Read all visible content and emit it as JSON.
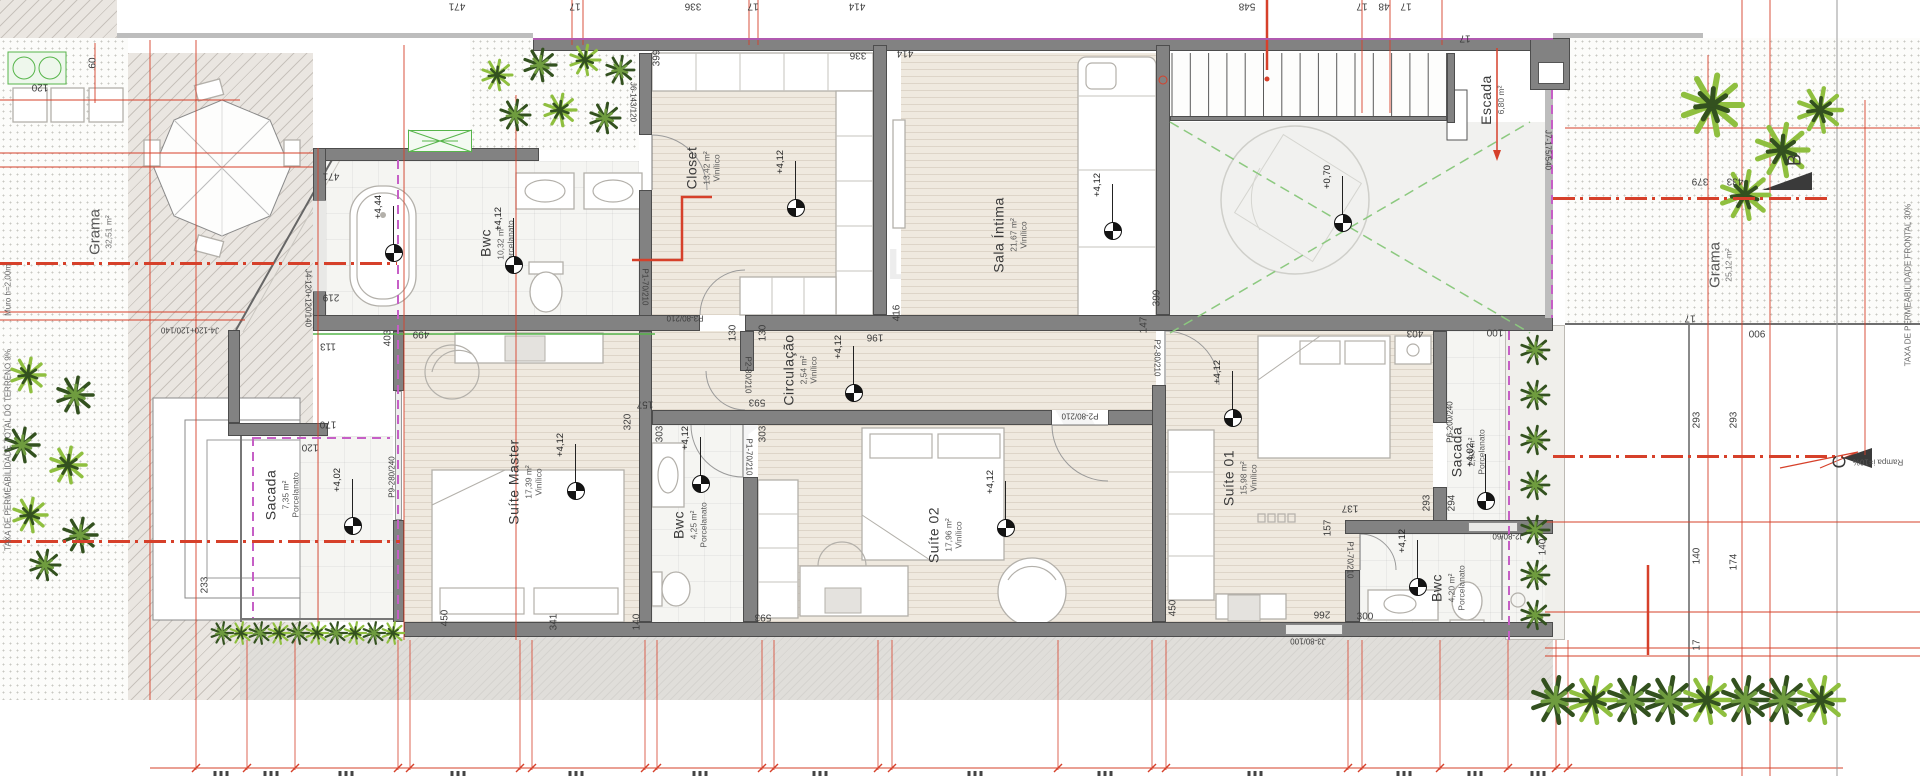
{
  "plan": {
    "colors": {
      "accent_red": "#d6402a",
      "wall_gray": "#828282",
      "magenta": "#c65fc6",
      "green_window": "#57b54b",
      "green_dash": "#8cc97f",
      "palm_dark": "#33511f",
      "palm_light": "#8fbf3f"
    },
    "watermark": {
      "brand": "IMOBILIÁRIA",
      "monogram": "KIN"
    },
    "yard_left": {
      "name": "Grama",
      "area": "32,51 m²",
      "x": 100,
      "y": 232
    },
    "yard_right": {
      "name": "Grama",
      "area": "25,12 m²",
      "x": 1720,
      "y": 265
    },
    "notes": {
      "left_wall": {
        "text": "Muro h=2,00m",
        "x": 8,
        "y": 290,
        "r": -90
      },
      "left_taxa": {
        "text": "TAXA DE PERMEABILIDADE TOTAL DO TERRENO 9%",
        "x": 8,
        "y": 450,
        "r": -90
      },
      "right_taxa": {
        "text": "TAXA DE PERMEABILIDADE FRONTAL 30%",
        "x": 1908,
        "y": 285,
        "r": -90
      },
      "ramp": {
        "text": "Rampa i=10%",
        "x": 1878,
        "y": 462,
        "r": 180
      }
    },
    "section_markers": [
      {
        "label": "B",
        "x": 1795,
        "y": 160
      },
      {
        "label": "C",
        "x": 1840,
        "y": 462
      }
    ],
    "rooms": [
      {
        "id": "bwc-master",
        "name": "Bwc",
        "area": "10,32 m²",
        "material": "Porcelanato",
        "floor": "porc",
        "x": 326,
        "y": 161,
        "w": 313,
        "h": 154,
        "lx": 497,
        "ly": 243
      },
      {
        "id": "closet",
        "name": "Closet",
        "area": "13,42 m²",
        "material": "Vinílico",
        "floor": "wood",
        "x": 652,
        "y": 53,
        "w": 221,
        "h": 262,
        "lx": 703,
        "ly": 168
      },
      {
        "id": "sala-intima",
        "name": "Sala Íntima",
        "area": "21,67 m²",
        "material": "Vinílico",
        "floor": "wood",
        "x": 901,
        "y": 53,
        "w": 255,
        "h": 262,
        "lx": 1010,
        "ly": 235
      },
      {
        "id": "escada",
        "name": "Escada",
        "area": "6,80 m²",
        "material": "",
        "floor": "none",
        "x": 1170,
        "y": 53,
        "w": 277,
        "h": 63,
        "lx": 1492,
        "ly": 100
      },
      {
        "id": "circulacao",
        "name": "Circulação",
        "area": "2,54 m²",
        "material": "Vinílico",
        "floor": "wood",
        "x": 652,
        "y": 331,
        "w": 504,
        "h": 79,
        "lx": 800,
        "ly": 370
      },
      {
        "id": "suite-master",
        "name": "Suíte Master",
        "area": "17,39 m²",
        "material": "Vinílico",
        "floor": "wood",
        "x": 404,
        "y": 331,
        "w": 235,
        "h": 291,
        "lx": 525,
        "ly": 482
      },
      {
        "id": "sacada-esq",
        "name": "Sacada",
        "area": "7,35 m²",
        "material": "Porcelanato",
        "floor": "porc",
        "x": 240,
        "y": 436,
        "w": 153,
        "h": 186,
        "lx": 282,
        "ly": 495
      },
      {
        "id": "bwc-meio",
        "name": "Bwc",
        "area": "4,25 m²",
        "material": "Porcelanato",
        "floor": "porc",
        "x": 652,
        "y": 425,
        "w": 91,
        "h": 197,
        "lx": 690,
        "ly": 525
      },
      {
        "id": "suite-02",
        "name": "Suíte 02",
        "area": "17,96 m²",
        "material": "Vinílico",
        "floor": "wood",
        "x": 758,
        "y": 425,
        "w": 394,
        "h": 197,
        "lx": 945,
        "ly": 535
      },
      {
        "id": "suite-01",
        "name": "Suíte 01",
        "area": "15,98 m²",
        "material": "Vinílico",
        "floor": "wood",
        "x": 1166,
        "y": 331,
        "w": 267,
        "h": 291,
        "lx": 1240,
        "ly": 478
      },
      {
        "id": "sacada-dir",
        "name": "Sacada",
        "area": "2,93 m²",
        "material": "Porcelanato",
        "floor": "porc",
        "x": 1447,
        "y": 331,
        "w": 58,
        "h": 291,
        "lx": 1468,
        "ly": 452
      },
      {
        "id": "bwc-suite01",
        "name": "Bwc",
        "area": "4,20 m²",
        "material": "Porcelanato",
        "floor": "porc",
        "x": 1360,
        "y": 534,
        "w": 185,
        "h": 88,
        "lx": 1448,
        "ly": 588
      }
    ],
    "levels": [
      {
        "v": "+4,44",
        "x": 393,
        "y": 252
      },
      {
        "v": "+4,12",
        "x": 513,
        "y": 264
      },
      {
        "v": "+4,12",
        "x": 795,
        "y": 207
      },
      {
        "v": "+4,12",
        "x": 1112,
        "y": 230
      },
      {
        "v": "+0,70",
        "x": 1342,
        "y": 222
      },
      {
        "v": "+4,12",
        "x": 853,
        "y": 392
      },
      {
        "v": "+4,12",
        "x": 575,
        "y": 490
      },
      {
        "v": "+4,02",
        "x": 352,
        "y": 525
      },
      {
        "v": "+4,12",
        "x": 700,
        "y": 483
      },
      {
        "v": "+4,12",
        "x": 1005,
        "y": 527
      },
      {
        "v": "+4,12",
        "x": 1232,
        "y": 417
      },
      {
        "v": "+4,02",
        "x": 1485,
        "y": 500
      },
      {
        "v": "+4,12",
        "x": 1417,
        "y": 586
      }
    ],
    "dims": [
      {
        "t": "471",
        "x": 457,
        "y": 6,
        "r": 180
      },
      {
        "t": "17",
        "x": 575,
        "y": 6,
        "r": 180
      },
      {
        "t": "336",
        "x": 693,
        "y": 6,
        "r": 180
      },
      {
        "t": "17",
        "x": 753,
        "y": 6,
        "r": 180
      },
      {
        "t": "414",
        "x": 857,
        "y": 6,
        "r": 180
      },
      {
        "t": "548",
        "x": 1247,
        "y": 6,
        "r": 180
      },
      {
        "t": "17",
        "x": 1362,
        "y": 6,
        "r": 180
      },
      {
        "t": "48",
        "x": 1384,
        "y": 6,
        "r": 180
      },
      {
        "t": "17",
        "x": 1406,
        "y": 6,
        "r": 180
      },
      {
        "t": "17",
        "x": 1465,
        "y": 38,
        "r": 180
      },
      {
        "t": "60",
        "x": 93,
        "y": 63,
        "r": -90
      },
      {
        "t": "120",
        "x": 40,
        "y": 87,
        "r": 180
      },
      {
        "t": "471",
        "x": 331,
        "y": 176,
        "r": 180
      },
      {
        "t": "219",
        "x": 331,
        "y": 297,
        "r": 180
      },
      {
        "t": "113",
        "x": 328,
        "y": 346,
        "r": 180
      },
      {
        "t": "170",
        "x": 328,
        "y": 424,
        "r": 180
      },
      {
        "t": "120",
        "x": 310,
        "y": 447,
        "r": 180
      },
      {
        "t": "233",
        "x": 205,
        "y": 585,
        "r": -90
      },
      {
        "t": "403",
        "x": 388,
        "y": 338,
        "r": -90
      },
      {
        "t": "499",
        "x": 421,
        "y": 334,
        "r": 180
      },
      {
        "t": "399",
        "x": 657,
        "y": 58,
        "r": -90
      },
      {
        "t": "336",
        "x": 858,
        "y": 55,
        "r": 180
      },
      {
        "t": "414",
        "x": 905,
        "y": 53,
        "r": 180
      },
      {
        "t": "130",
        "x": 733,
        "y": 333,
        "r": -90
      },
      {
        "t": "130",
        "x": 763,
        "y": 333,
        "r": -90
      },
      {
        "t": "196",
        "x": 875,
        "y": 337,
        "r": 180
      },
      {
        "t": "416",
        "x": 897,
        "y": 313,
        "r": -90
      },
      {
        "t": "593",
        "x": 757,
        "y": 402,
        "r": 180
      },
      {
        "t": "157",
        "x": 645,
        "y": 404,
        "r": 180
      },
      {
        "t": "320",
        "x": 628,
        "y": 422,
        "r": -90
      },
      {
        "t": "303",
        "x": 660,
        "y": 434,
        "r": -90
      },
      {
        "t": "303",
        "x": 763,
        "y": 434,
        "r": -90
      },
      {
        "t": "399",
        "x": 1157,
        "y": 298,
        "r": -90
      },
      {
        "t": "147",
        "x": 1144,
        "y": 325,
        "r": -90
      },
      {
        "t": "450",
        "x": 445,
        "y": 618,
        "r": -90
      },
      {
        "t": "341",
        "x": 554,
        "y": 622,
        "r": -90
      },
      {
        "t": "140",
        "x": 637,
        "y": 622,
        "r": -90
      },
      {
        "t": "593",
        "x": 763,
        "y": 617,
        "r": 180
      },
      {
        "t": "450",
        "x": 1173,
        "y": 608,
        "r": -90
      },
      {
        "t": "266",
        "x": 1322,
        "y": 614,
        "r": 180
      },
      {
        "t": "300",
        "x": 1365,
        "y": 617,
        "r": 0
      },
      {
        "t": "137",
        "x": 1350,
        "y": 508,
        "r": 180
      },
      {
        "t": "157",
        "x": 1328,
        "y": 528,
        "r": -90
      },
      {
        "t": "293",
        "x": 1427,
        "y": 503,
        "r": -90
      },
      {
        "t": "294",
        "x": 1452,
        "y": 503,
        "r": -90
      },
      {
        "t": "140",
        "x": 1543,
        "y": 547,
        "r": -90
      },
      {
        "t": "100",
        "x": 1495,
        "y": 332,
        "r": 180
      },
      {
        "t": "403",
        "x": 1415,
        "y": 333,
        "r": 180
      },
      {
        "t": "379",
        "x": 1700,
        "y": 181,
        "r": 180
      },
      {
        "t": "433",
        "x": 1735,
        "y": 181,
        "r": 180
      },
      {
        "t": "17",
        "x": 1690,
        "y": 318,
        "r": 180
      },
      {
        "t": "900",
        "x": 1757,
        "y": 333,
        "r": 180
      },
      {
        "t": "293",
        "x": 1697,
        "y": 420,
        "r": -90
      },
      {
        "t": "293",
        "x": 1734,
        "y": 420,
        "r": -90
      },
      {
        "t": "140",
        "x": 1697,
        "y": 556,
        "r": -90
      },
      {
        "t": "174",
        "x": 1734,
        "y": 562,
        "r": -90
      },
      {
        "t": "17",
        "x": 1697,
        "y": 645,
        "r": -90
      },
      {
        "t": "J4-120+120/140",
        "x": 308,
        "y": 298,
        "r": 90,
        "s": 8
      },
      {
        "t": "J4-120+120/140",
        "x": 190,
        "y": 330,
        "r": 180,
        "s": 8
      },
      {
        "t": "J6-143/120",
        "x": 633,
        "y": 102,
        "r": 90,
        "s": 8
      },
      {
        "t": "J7-175/540",
        "x": 1548,
        "y": 150,
        "r": 90,
        "s": 8
      },
      {
        "t": "P9-280/240",
        "x": 392,
        "y": 477,
        "r": -90,
        "s": 8
      },
      {
        "t": "P1-70/210",
        "x": 645,
        "y": 287,
        "r": 90,
        "s": 8
      },
      {
        "t": "P3-80/210",
        "x": 685,
        "y": 318,
        "r": 180,
        "s": 8
      },
      {
        "t": "P2-80/210",
        "x": 748,
        "y": 375,
        "r": 90,
        "s": 8
      },
      {
        "t": "P1-70/210",
        "x": 749,
        "y": 457,
        "r": 90,
        "s": 8
      },
      {
        "t": "P2-80/210",
        "x": 1080,
        "y": 416,
        "r": 180,
        "s": 8
      },
      {
        "t": "P2-80/210",
        "x": 1157,
        "y": 358,
        "r": 90,
        "s": 8
      },
      {
        "t": "P6-200/240",
        "x": 1450,
        "y": 422,
        "r": -90,
        "s": 8
      },
      {
        "t": "P1-70/210",
        "x": 1350,
        "y": 560,
        "r": 90,
        "s": 8
      },
      {
        "t": "J2-80/60",
        "x": 1508,
        "y": 536,
        "r": 180,
        "s": 8
      },
      {
        "t": "J3-80/100",
        "x": 1308,
        "y": 641,
        "r": 180,
        "s": 8
      }
    ]
  }
}
